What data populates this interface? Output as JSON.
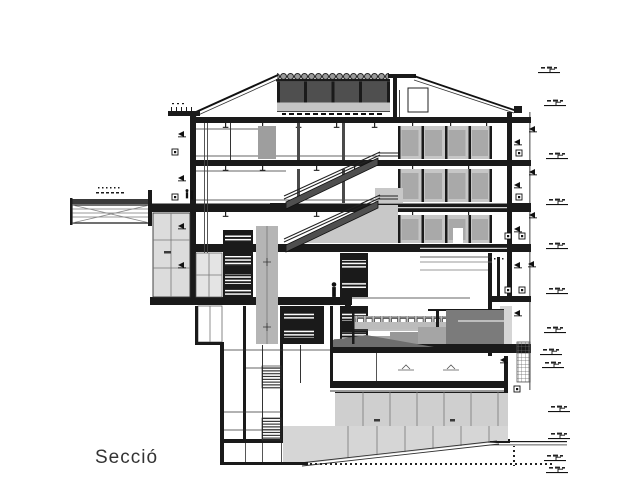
{
  "drawing": {
    "title": "Secció",
    "colors": {
      "ink": "#1a1a1a",
      "clerestory": "#4f4f4f",
      "seating_dark": "#7b7b7b",
      "panel": "#c6c6c6",
      "panel_inner": "#a9a9a9",
      "wing": "#dcdcdc",
      "earth": "#cfcfcf",
      "mid_gray": "#a0a0a0",
      "rail": "#4f4f4f",
      "background": "#ffffff"
    }
  }
}
